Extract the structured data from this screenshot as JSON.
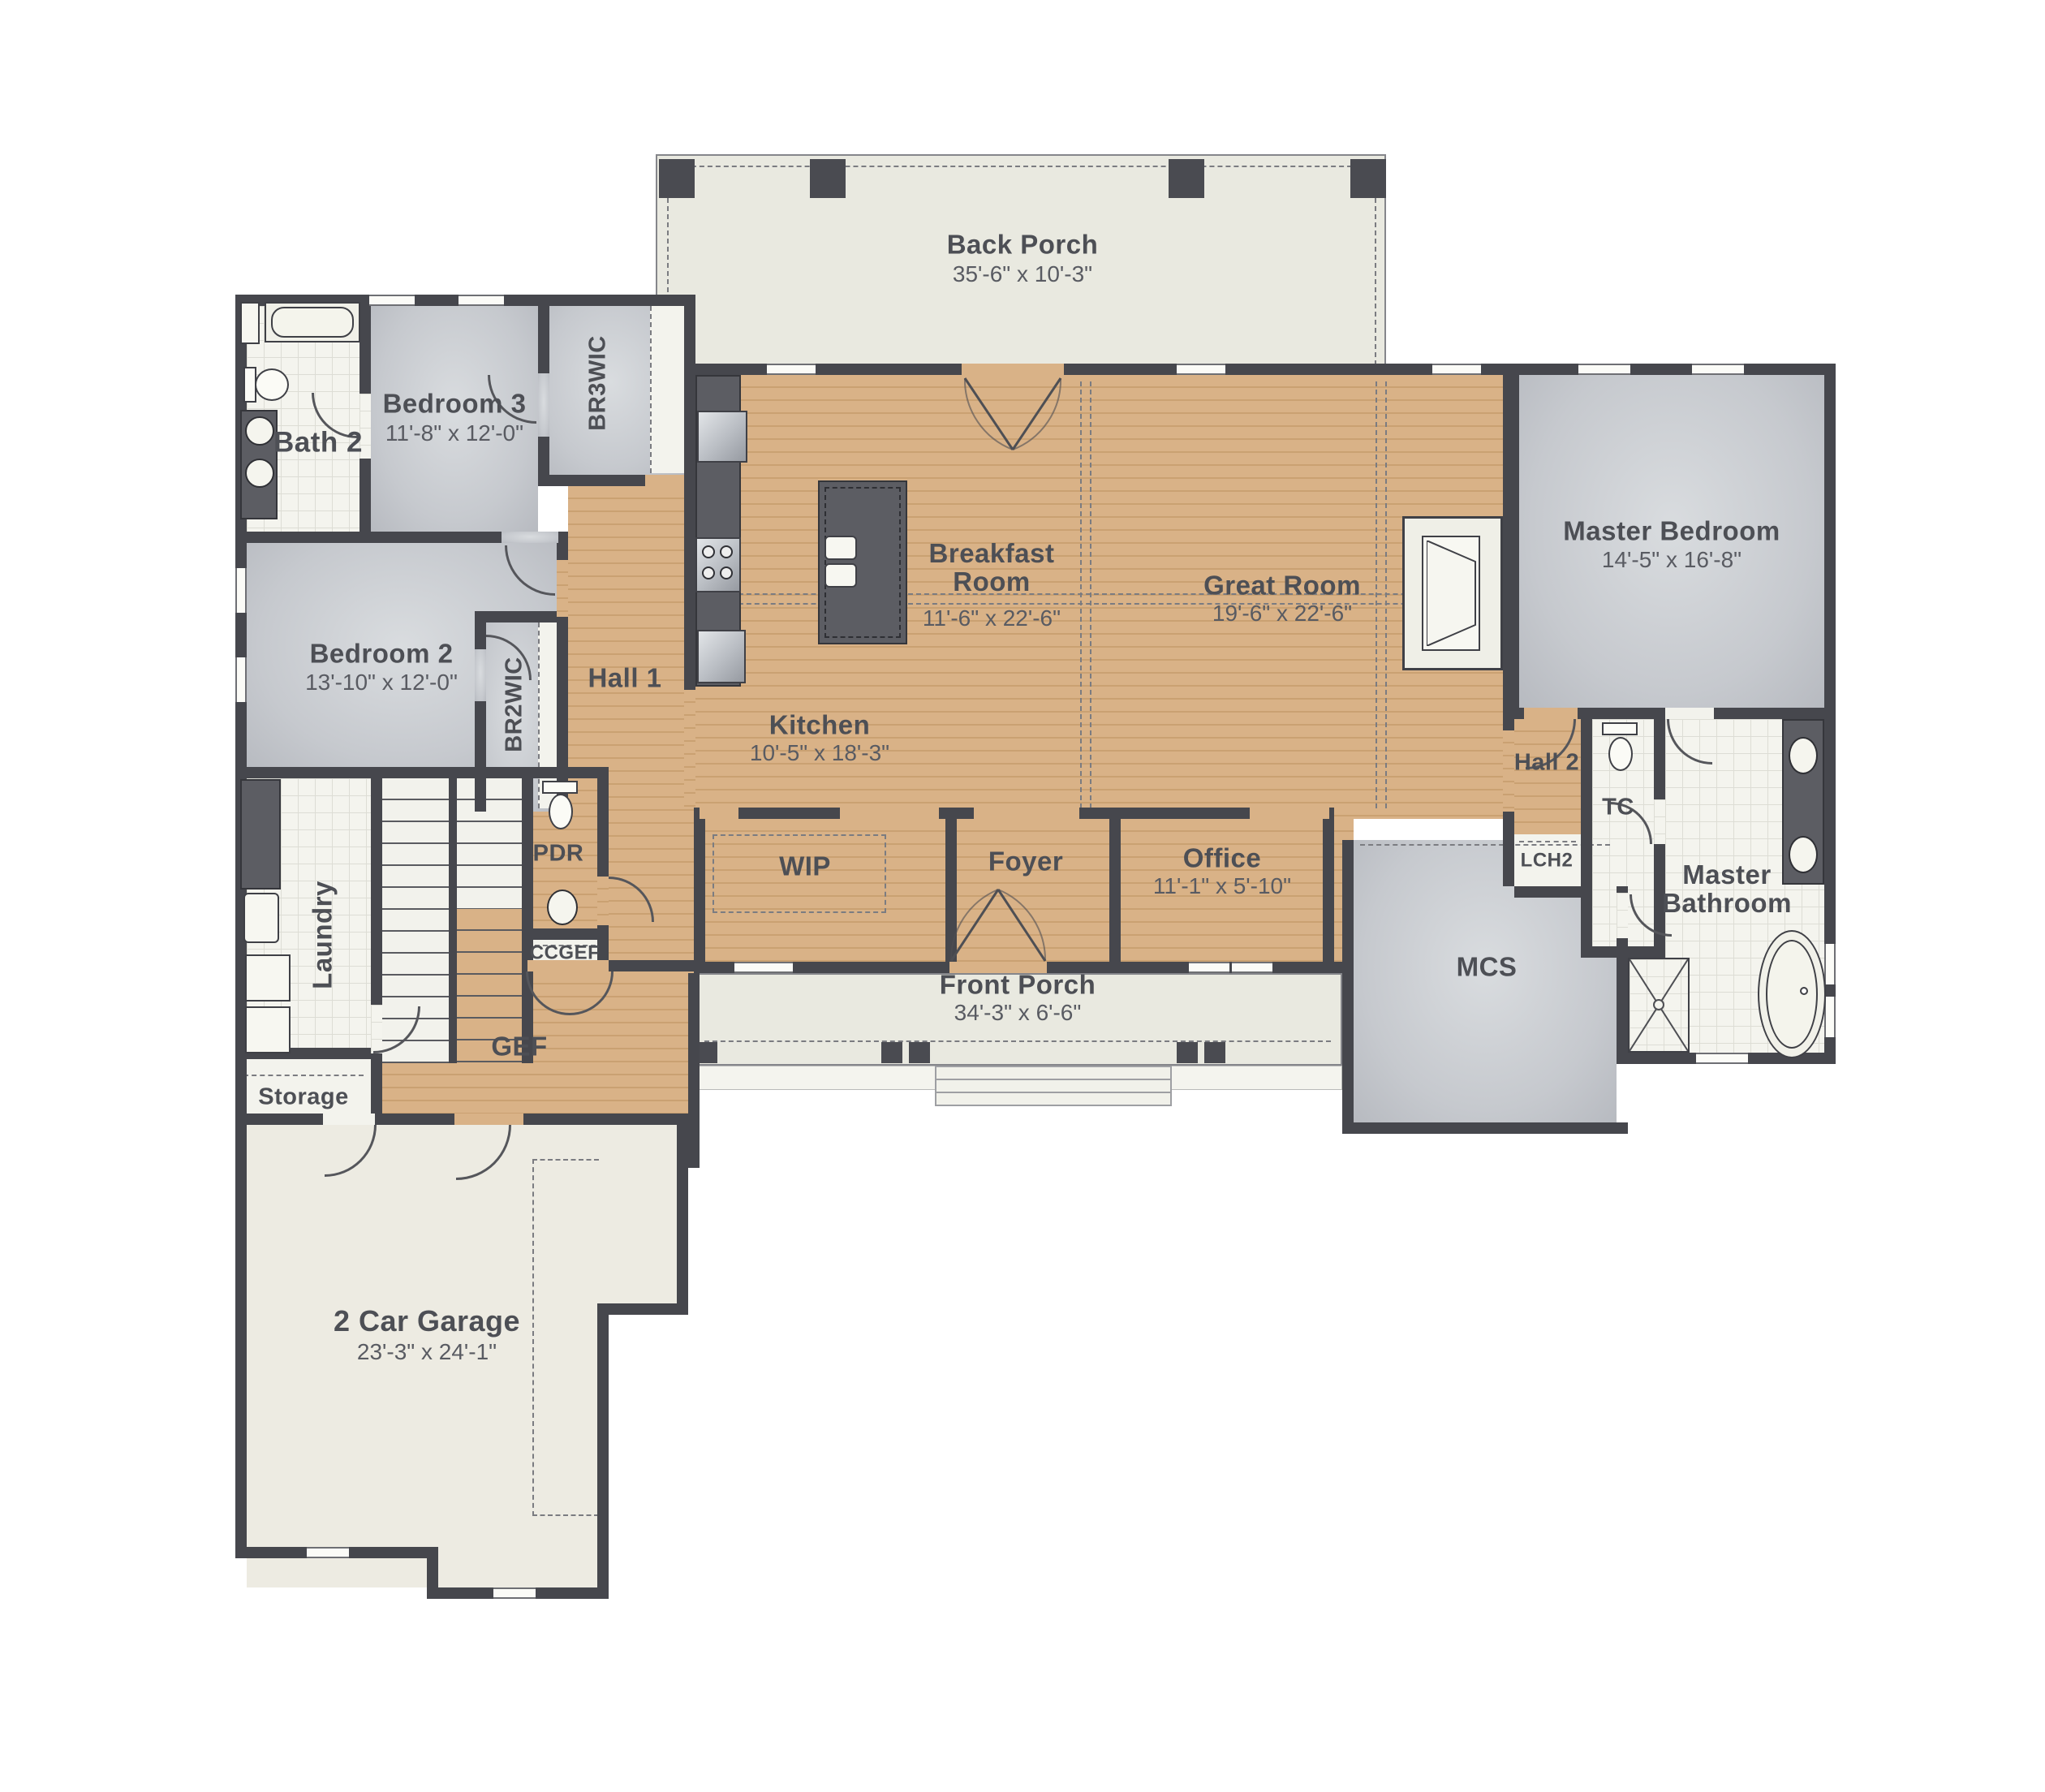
{
  "plan_type": "first-floor residential floor plan",
  "rooms": {
    "back_porch": {
      "name": "Back Porch",
      "dims": "35'-6\" x 10'-3\""
    },
    "bath2": {
      "name": "Bath 2"
    },
    "bedroom3": {
      "name": "Bedroom 3",
      "dims": "11'-8\" x 12'-0\""
    },
    "br3wic": {
      "name": "BR3WIC"
    },
    "bedroom2": {
      "name": "Bedroom 2",
      "dims": "13'-10\" x 12'-0\""
    },
    "br2wic": {
      "name": "BR2WIC"
    },
    "hall1": {
      "name": "Hall 1"
    },
    "kitchen": {
      "name": "Kitchen",
      "dims": "10'-5\" x 18'-3\""
    },
    "breakfast_room": {
      "name": "Breakfast Room",
      "dims": "11'-6\" x 22'-6\""
    },
    "great_room": {
      "name": "Great Room",
      "dims": "19'-6\" x 22'-6\""
    },
    "master_bedroom": {
      "name": "Master Bedroom",
      "dims": "14'-5\" x 16'-8\""
    },
    "hall2": {
      "name": "Hall 2"
    },
    "tc": {
      "name": "TC"
    },
    "lch2": {
      "name": "LCH2"
    },
    "master_bathroom": {
      "name": "Master Bathroom"
    },
    "mcs": {
      "name": "MCS"
    },
    "office": {
      "name": "Office",
      "dims": "11'-1\" x 5'-10\""
    },
    "foyer": {
      "name": "Foyer"
    },
    "wip": {
      "name": "WIP"
    },
    "pdr": {
      "name": "PDR"
    },
    "ccgef": {
      "name": "CCGEF"
    },
    "gef": {
      "name": "GEF"
    },
    "laundry": {
      "name": "Laundry"
    },
    "storage": {
      "name": "Storage"
    },
    "front_porch": {
      "name": "Front Porch",
      "dims": "34'-3\" x 6'-6\""
    },
    "garage": {
      "name": "2 Car Garage",
      "dims": "23'-3\" x 24'-1\""
    }
  },
  "colors": {
    "wall": "#46474d",
    "wood_floor": "#d9b287",
    "carpet": "#c6c9ce",
    "tile": "#f4f4ee",
    "porch": "#e9e9e0",
    "label_text": "#4d4f55",
    "dims_text": "#595b62"
  }
}
